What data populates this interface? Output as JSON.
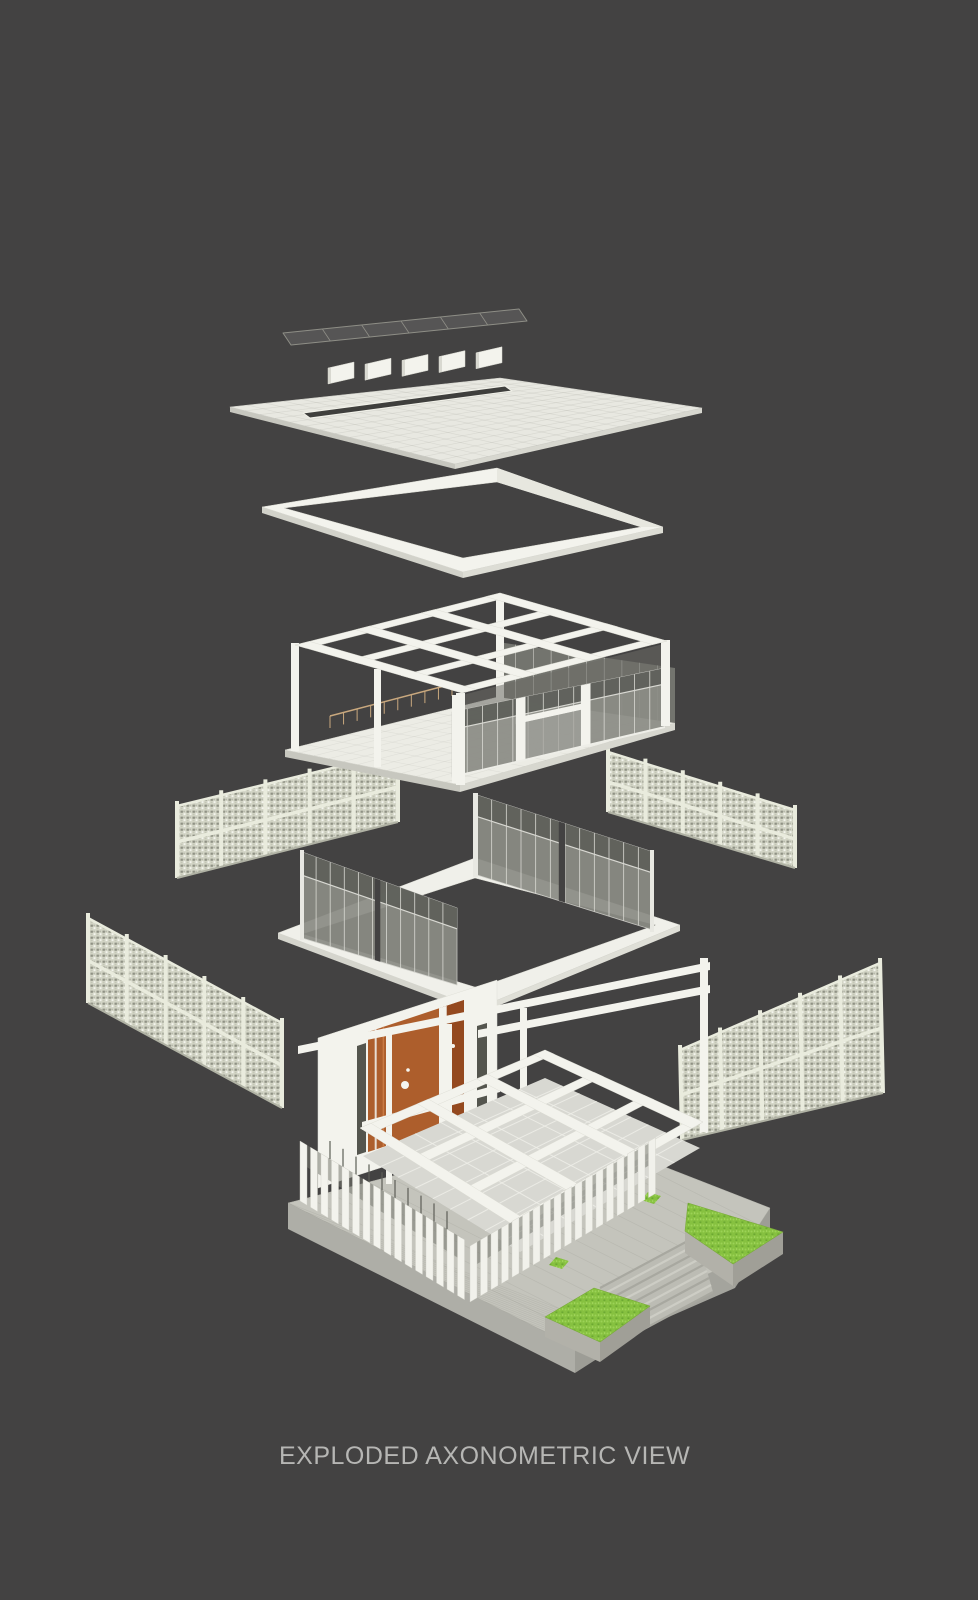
{
  "caption": {
    "text": "EXPLODED AXONOMETRIC VIEW"
  },
  "scene": {
    "background": "#434242",
    "palette": {
      "structure_white": "#f3f3ed",
      "structure_shade": "#d8d8d0",
      "roof_top": "#e8e8e1",
      "slab_edge_left": "#c7c7bf",
      "slab_edge_right": "#d7d7cf",
      "slot_dark": "#3f3f3d",
      "glass": "#8b8c85",
      "glass_dark": "#5f605b",
      "glass_light": "#9fa09a",
      "mullion": "#d8d8d2",
      "screen_base": "#d3d5c6",
      "screen_frame": "#e9ebdd",
      "screen_shadow": "#b0b2a4",
      "door_orange": "#ad5e2c",
      "door_orange_dark": "#94491f",
      "plinth_top": "#c4c4bc",
      "plinth_side": "#aeaea7",
      "plinth_side_dark": "#9d9d96",
      "grass": "#86c140",
      "railing_tan": "#c9a87e",
      "caption_gray": "#b6b6b4",
      "dark_slit": "#54554e",
      "tile_floor": "#d8d8d2",
      "tile_grout": "#efefe9"
    },
    "layers": [
      {
        "id": "skylight-strip",
        "label": "Skylight glazing strip"
      },
      {
        "id": "clerestory-panels",
        "label": "Clerestory panels"
      },
      {
        "id": "roof-slab",
        "label": "Roof slab"
      },
      {
        "id": "parapet-ring",
        "label": "Parapet ring"
      },
      {
        "id": "screen-upper-left",
        "label": "Perforated screen upper left"
      },
      {
        "id": "screen-upper-right",
        "label": "Perforated screen upper right"
      },
      {
        "id": "pavilion-frame",
        "label": "Pavilion frame and glazing"
      },
      {
        "id": "glass-partition-ring",
        "label": "Glass partition ring"
      },
      {
        "id": "screen-lower-left",
        "label": "Perforated screen lower left"
      },
      {
        "id": "screen-lower-right",
        "label": "Perforated screen lower right"
      },
      {
        "id": "base-plinth",
        "label": "Base plinth and landscape"
      },
      {
        "id": "entry-core",
        "label": "Entry core and fin colonnade"
      }
    ]
  }
}
